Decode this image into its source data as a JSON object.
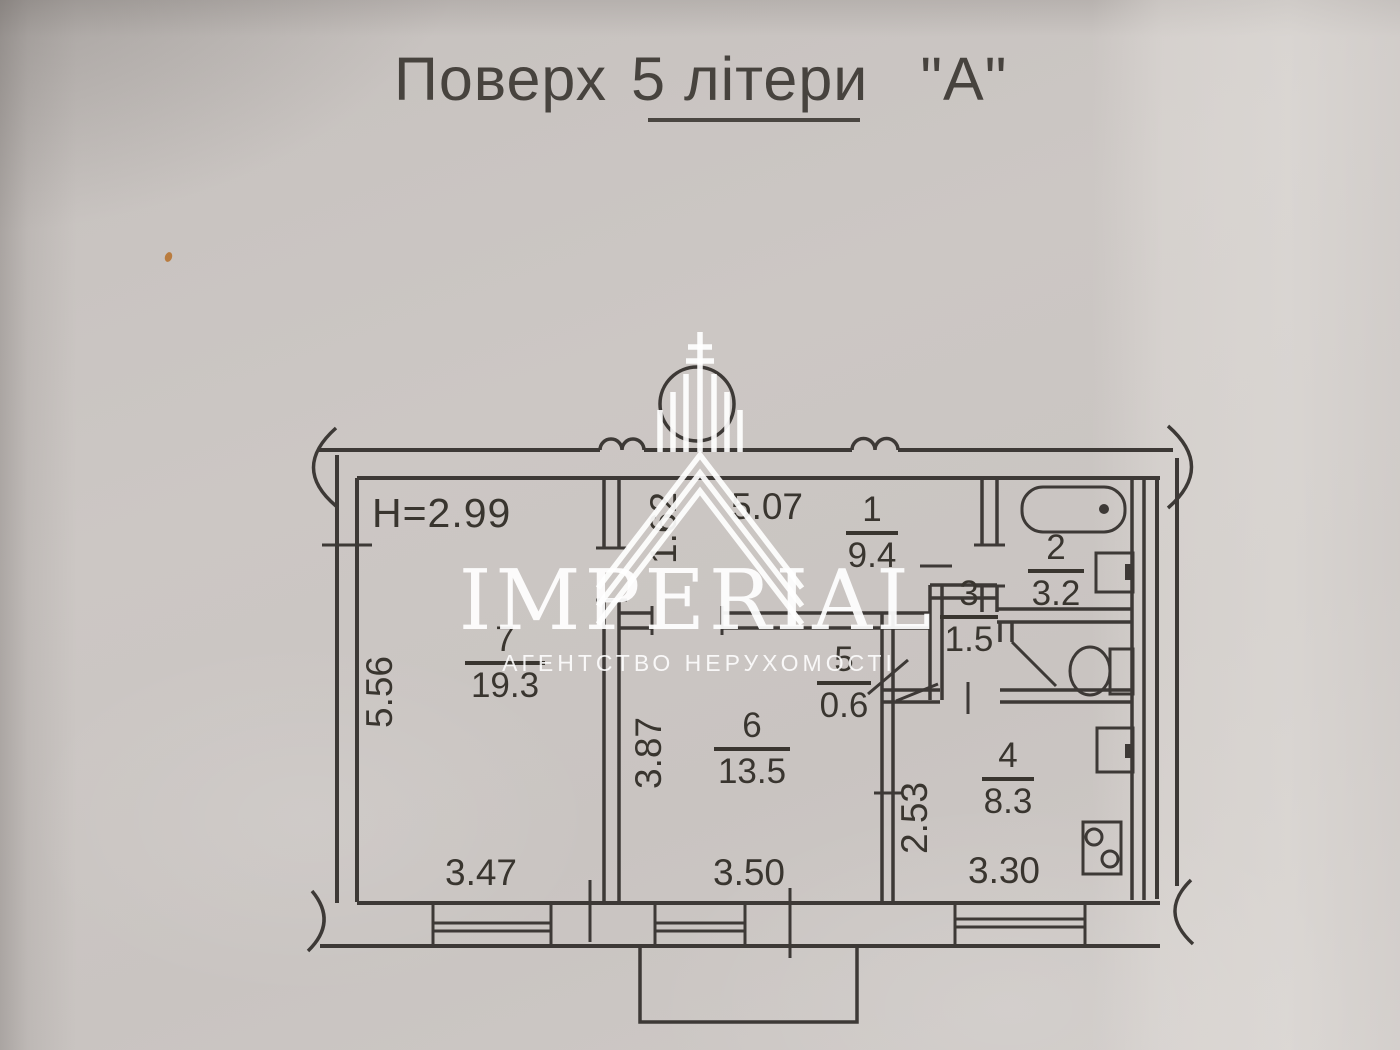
{
  "title": {
    "part1": "Поверх",
    "part2": "5 літери",
    "part3": "\"А\""
  },
  "watermark": {
    "brand": "IMPERIAL",
    "tagline": "АГЕНТСТВО НЕРУХОМОСТІ"
  },
  "plan": {
    "ceiling_height": "H=2.99",
    "rooms": {
      "r1": {
        "number": "1",
        "area": "9.4"
      },
      "r2": {
        "number": "2",
        "area": "3.2"
      },
      "r3": {
        "number": "3",
        "area": "1.5"
      },
      "r4": {
        "number": "4",
        "area": "8.3"
      },
      "r5": {
        "number": "5",
        "area": "0.6"
      },
      "r6": {
        "number": "6",
        "area": "13.5"
      },
      "r7": {
        "number": "7",
        "area": "19.3"
      }
    },
    "dimensions": {
      "room7_width": "3.47",
      "room7_depth": "5.56",
      "room6_width": "3.50",
      "room6_depth": "3.87",
      "kitchen_width": "3.30",
      "kitchen_depth": "2.53",
      "hall_length": "5.07",
      "hall_width": "1.62"
    }
  },
  "colors": {
    "paper": "#cbc6c3",
    "ink": "#3c3835",
    "watermark": "#ffffff"
  }
}
